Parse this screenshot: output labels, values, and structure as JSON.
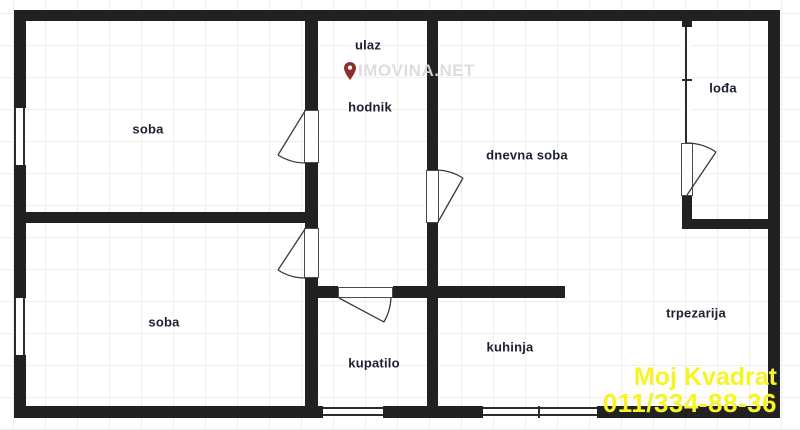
{
  "rooms": {
    "ulaz": "ulaz",
    "hodnik": "hodnik",
    "soba_top": "soba",
    "dnevna_soba": "dnevna soba",
    "loda": "lođa",
    "soba_bottom": "soba",
    "kupatilo": "kupatilo",
    "kuhinja": "kuhinja",
    "trpezarija": "trpezarija"
  },
  "watermark": {
    "text": "IMOVINA.NET",
    "icon": "map-pin-icon"
  },
  "branding": {
    "company": "Moj Kvadrat",
    "phone": "011/334-88-36"
  },
  "colors": {
    "wall": "#212121",
    "label_text": "#1b2130",
    "grid": "#f0eded",
    "watermark_text": "#dedada",
    "brand_yellow": "#f7f325",
    "pin_red": "#8f2f2a"
  }
}
